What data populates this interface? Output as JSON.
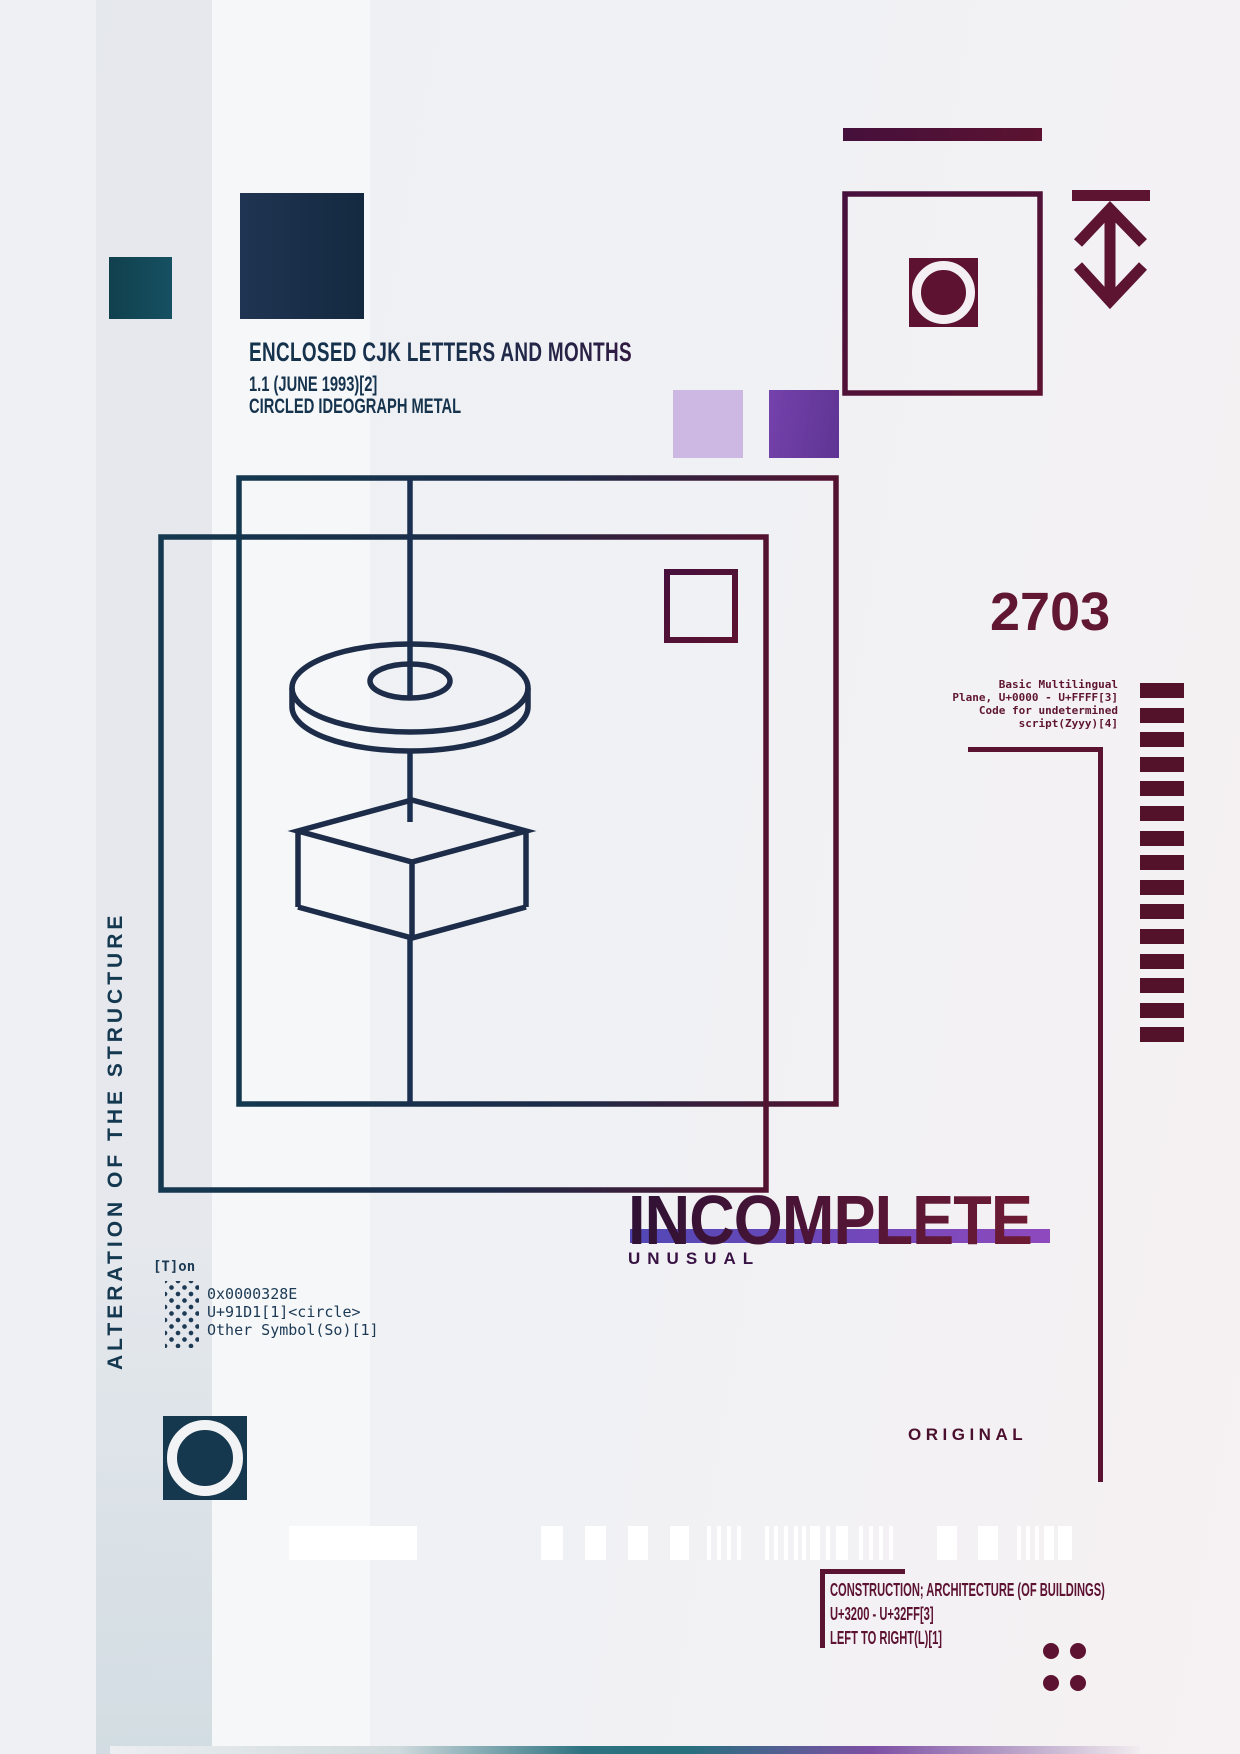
{
  "poster": {
    "header": {
      "title": "ENCLOSED CJK LETTERS AND MONTHS",
      "version": "1.1 (JUNE 1993)[2]",
      "subtitle": "CIRCLED IDEOGRAPH METAL"
    },
    "big_number": "2703",
    "plane_block": {
      "lines": [
        "Basic Multilingual",
        "Plane, U+0000 - U+FFFF[3]",
        "Code for undetermined",
        "script(Zyyy)[4]"
      ]
    },
    "side_text": "ALTERATION OF THE STRUCTURE",
    "token_label": "[T]on",
    "code_block": {
      "lines": [
        "0x0000328E",
        "U+91D1[1]<circle>",
        "Other Symbol(So)[1]"
      ]
    },
    "incomplete_title": "INCOMPLETE",
    "incomplete_subtitle": "UNUSUAL",
    "original_label": "ORIGINAL",
    "footer_block": {
      "lines": [
        "CONSTRUCTION; ARCHITECTURE (OF BUILDINGS)",
        "U+3200 - U+32FF[3]",
        "LEFT TO RIGHT(L)[1]"
      ]
    },
    "colors": {
      "navy": "#16334d",
      "teal": "#123f4e",
      "maroon": "#5c1230",
      "purple_light": "#ccb8e2",
      "purple": "#6f3ca6",
      "indigo_bar_left": "#5148b5",
      "indigo_bar_right": "#8e49bd",
      "background_left": "#eef0f3",
      "background_right": "#f6f1f3"
    },
    "icons": [
      "height-arrow-icon",
      "target-circle-icon",
      "ring-circle-icon",
      "dot-grid-icon",
      "barcode-icon",
      "corner-dots-icon"
    ]
  },
  "decor": {
    "ladder": {
      "count": 15
    },
    "barcode": {
      "bars": [
        [
          289,
          128
        ],
        [
          541,
          22
        ],
        [
          585,
          21
        ],
        [
          628,
          20
        ],
        [
          670,
          19
        ],
        [
          707,
          4
        ],
        [
          717,
          4
        ],
        [
          727,
          4
        ],
        [
          737,
          4
        ],
        [
          765,
          4
        ],
        [
          774,
          4
        ],
        [
          784,
          4
        ],
        [
          794,
          4
        ],
        [
          802,
          4
        ],
        [
          810,
          10
        ],
        [
          826,
          4
        ],
        [
          836,
          12
        ],
        [
          859,
          4
        ],
        [
          869,
          4
        ],
        [
          879,
          4
        ],
        [
          889,
          4
        ],
        [
          937,
          20
        ],
        [
          978,
          20
        ],
        [
          1017,
          4
        ],
        [
          1026,
          4
        ],
        [
          1035,
          4
        ],
        [
          1044,
          10
        ],
        [
          1058,
          14
        ]
      ]
    },
    "corner_dots": {
      "rows": 2,
      "cols": 2
    }
  }
}
